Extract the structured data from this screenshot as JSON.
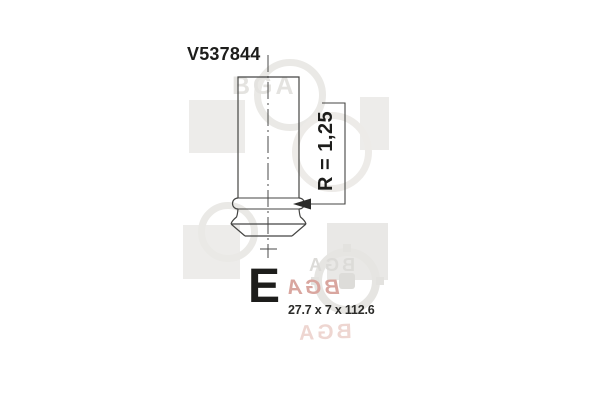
{
  "drawing": {
    "part_number": "V537844",
    "radius_label": "R = 1,25",
    "valve_type_letter": "E",
    "dimensions_label": "27.7 x 7 x 112.6"
  },
  "watermark": {
    "brand_text": "BGA",
    "gray_color": "#eae9e6",
    "pink_color": "#d9a69f"
  },
  "colors": {
    "line": "#454543",
    "text": "#1d1d1b",
    "background": "#ffffff"
  }
}
